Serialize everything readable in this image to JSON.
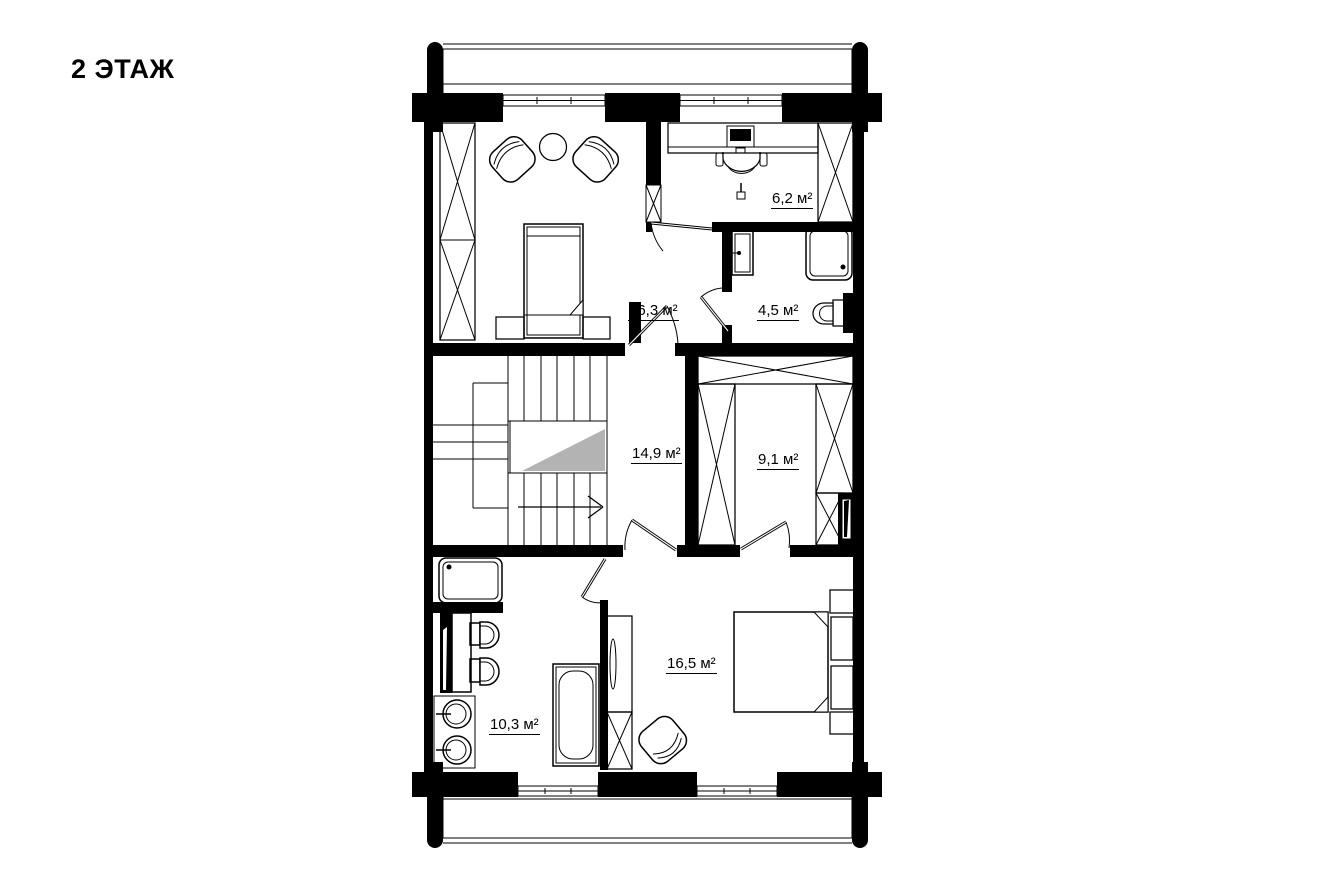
{
  "title": "2 ЭТАЖ",
  "plan": {
    "floor_label": "2 ЭТАЖ",
    "rooms": [
      {
        "name": "living-bedroom",
        "area": "16,3 м²"
      },
      {
        "name": "office",
        "area": "6,2 м²"
      },
      {
        "name": "bathroom-small",
        "area": "4,5 м²"
      },
      {
        "name": "hall-stairs",
        "area": "14,9 м²"
      },
      {
        "name": "wardrobe-room",
        "area": "9,1 м²"
      },
      {
        "name": "bedroom",
        "area": "16,5 м²"
      },
      {
        "name": "bathroom-large",
        "area": "10,3 м²"
      }
    ],
    "colors": {
      "walls": "#000000",
      "background": "#ffffff",
      "stair_marker": "#b3b3b3"
    }
  }
}
